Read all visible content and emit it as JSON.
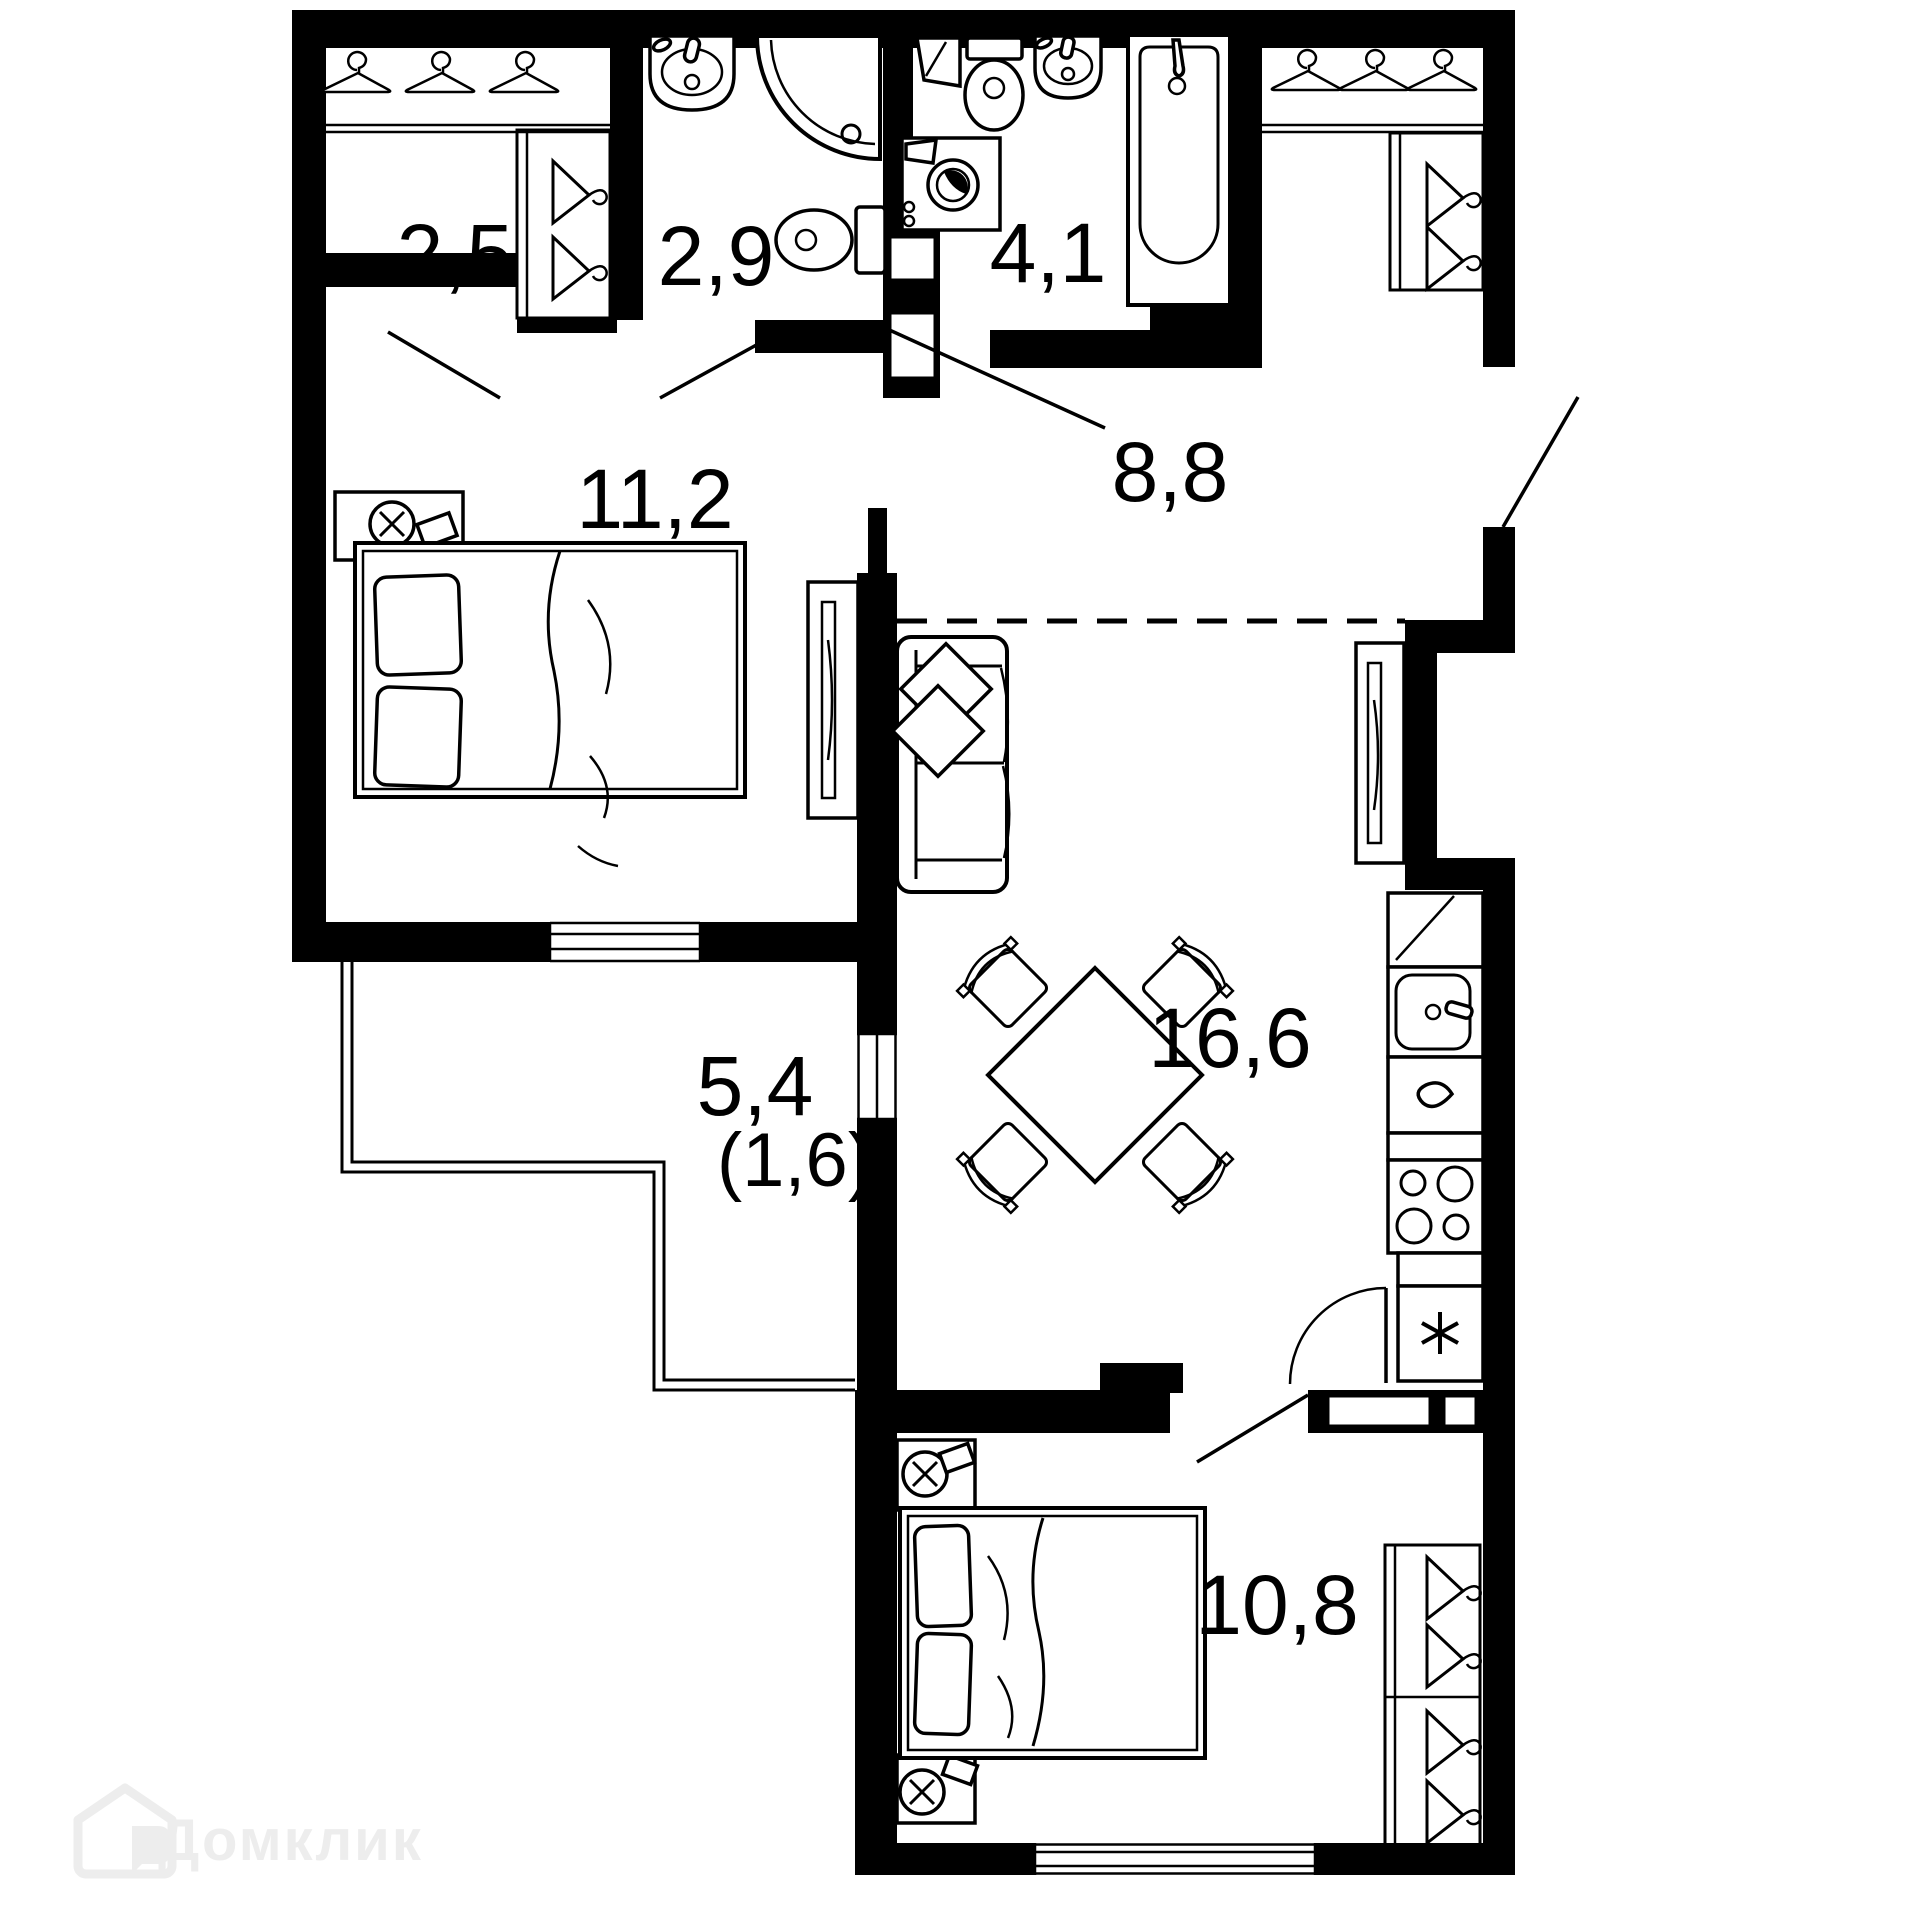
{
  "watermark": {
    "brand": "Домклик"
  },
  "rooms": {
    "wardrobe": {
      "area": "2,5"
    },
    "bathroom_small": {
      "area": "2,9"
    },
    "bathroom_large": {
      "area": "4,1"
    },
    "hallway": {
      "area": "8,8"
    },
    "bedroom": {
      "area": "11,2"
    },
    "living_kitchen": {
      "area": "16,6"
    },
    "balcony": {
      "area": "5,4",
      "area_reduced": "(1,6)"
    },
    "bedroom_second": {
      "area": "10,8"
    }
  },
  "colors": {
    "wall": "#000000",
    "background": "#ffffff",
    "watermark": "#ededed"
  }
}
